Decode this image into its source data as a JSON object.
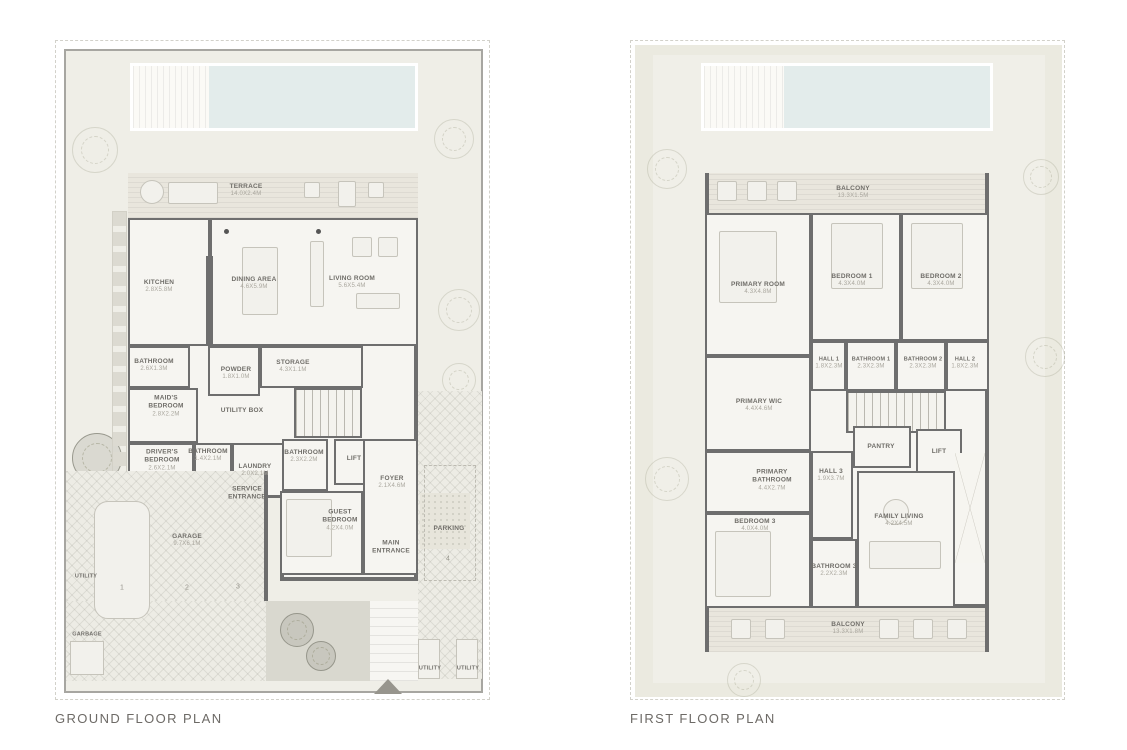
{
  "page": {
    "captions": {
      "ground": "GROUND FLOOR PLAN",
      "first": "FIRST FLOOR PLAN"
    }
  },
  "palette": {
    "wall": "#6e6e6e",
    "pool": "#e3eceb",
    "site": "#efeee7",
    "room": "#f6f5f1",
    "wood": "#e9e6dd",
    "hatch": "#edece5",
    "label": "#6f6d68",
    "dim": "#a9a69d"
  },
  "ground_floor": {
    "rooms": {
      "terrace": {
        "name": "TERRACE",
        "dim": "14.0X2.4M"
      },
      "kitchen": {
        "name": "KITCHEN",
        "dim": "2.8X5.8M"
      },
      "dining": {
        "name": "DINING AREA",
        "dim": "4.6X5.9M"
      },
      "living": {
        "name": "LIVING ROOM",
        "dim": "5.6X5.4M"
      },
      "bathroom_a": {
        "name": "BATHROOM",
        "dim": "2.6X1.3M"
      },
      "powder": {
        "name": "POWDER",
        "dim": "1.8X1.0M"
      },
      "storage": {
        "name": "STORAGE",
        "dim": "4.3X1.1M"
      },
      "maids_bedroom": {
        "name": "MAID'S BEDROOM",
        "dim": "2.8X2.2M"
      },
      "utility_box": {
        "name": "UTILITY BOX"
      },
      "drivers_bedroom": {
        "name": "DRIVER'S BEDROOM",
        "dim": "2.6X2.1M"
      },
      "bathroom_b": {
        "name": "BATHROOM",
        "dim": "1.4X2.1M"
      },
      "laundry": {
        "name": "LAUNDRY",
        "dim": "2.0X2.1M"
      },
      "bathroom_c": {
        "name": "BATHROOM",
        "dim": "2.3X2.2M"
      },
      "lift": {
        "name": "LIFT"
      },
      "foyer": {
        "name": "FOYER",
        "dim": "2.1X4.6M"
      },
      "service_entrance": {
        "name": "SERVICE ENTRANCE"
      },
      "guest_bedroom": {
        "name": "GUEST BEDROOM",
        "dim": "4.2X4.0M"
      },
      "main_entrance": {
        "name": "MAIN ENTRANCE"
      },
      "garage": {
        "name": "GARAGE",
        "dim": "9.7X6.1M"
      },
      "parking": {
        "name": "PARKING"
      },
      "utility_left": {
        "name": "UTILITY"
      },
      "garbage": {
        "name": "GARBAGE"
      },
      "utility_b1": {
        "name": "UTILITY"
      },
      "utility_b2": {
        "name": "UTILITY"
      }
    },
    "parking_spots": [
      "1",
      "2",
      "3",
      "4"
    ]
  },
  "first_floor": {
    "rooms": {
      "balcony_top": {
        "name": "BALCONY",
        "dim": "13.3X1.5M"
      },
      "primary_room": {
        "name": "PRIMARY ROOM",
        "dim": "4.3X4.8M"
      },
      "bedroom_1": {
        "name": "BEDROOM 1",
        "dim": "4.3X4.0M"
      },
      "bedroom_2": {
        "name": "BEDROOM 2",
        "dim": "4.3X4.0M"
      },
      "hall_1": {
        "name": "HALL 1",
        "dim": "1.8X2.3M"
      },
      "bathroom_1": {
        "name": "BATHROOM 1",
        "dim": "2.3X2.3M"
      },
      "bathroom_2": {
        "name": "BATHROOM 2",
        "dim": "2.3X2.3M"
      },
      "hall_2": {
        "name": "HALL 2",
        "dim": "1.8X2.3M"
      },
      "primary_wic": {
        "name": "PRIMARY WIC",
        "dim": "4.4X4.6M"
      },
      "primary_bathroom": {
        "name": "PRIMARY BATHROOM",
        "dim": "4.4X2.7M"
      },
      "hall_3": {
        "name": "HALL 3",
        "dim": "1.9X3.7M"
      },
      "pantry": {
        "name": "PANTRY"
      },
      "lift": {
        "name": "LIFT"
      },
      "bedroom_3": {
        "name": "BEDROOM 3",
        "dim": "4.0X4.0M"
      },
      "bathroom_3": {
        "name": "BATHROOM 3",
        "dim": "2.2X2.3M"
      },
      "family_living": {
        "name": "FAMILY LIVING",
        "dim": "4.2X4.5M"
      },
      "balcony_bottom": {
        "name": "BALCONY",
        "dim": "13.3X1.8M"
      }
    }
  }
}
